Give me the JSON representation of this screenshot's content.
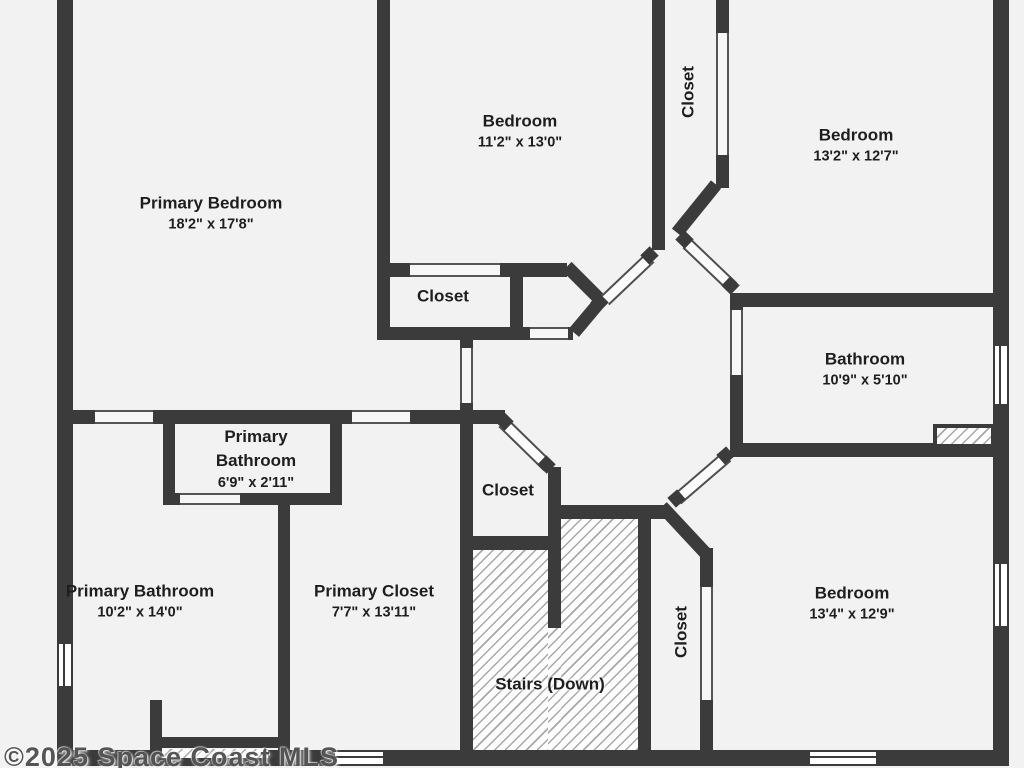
{
  "title": "Second floor plan",
  "watermark": "©2025 Space Coast MLS",
  "rooms": {
    "primary_bedroom": {
      "name": "Primary Bedroom",
      "dims": "18'2\" x 17'8\""
    },
    "bedroom_top": {
      "name": "Bedroom",
      "dims": "11'2\" x 13'0\""
    },
    "closet_top": {
      "name": "Closet"
    },
    "bedroom_right": {
      "name": "Bedroom",
      "dims": "13'2\" x 12'7\""
    },
    "closet_mid": {
      "name": "Closet"
    },
    "bathroom": {
      "name": "Bathroom",
      "dims": "10'9\" x 5'10\""
    },
    "primary_wc": {
      "name": "Primary Bathroom",
      "dims": "6'9\" x 2'11\""
    },
    "closet_hall": {
      "name": "Closet"
    },
    "primary_bathroom": {
      "name": "Primary Bathroom",
      "dims": "10'2\" x 14'0\""
    },
    "primary_closet": {
      "name": "Primary Closet",
      "dims": "7'7\" x 13'11\""
    },
    "stairs": {
      "name": "Stairs (Down)"
    },
    "closet_bottom": {
      "name": "Closet"
    },
    "bedroom_bottom": {
      "name": "Bedroom",
      "dims": "13'4\" x 12'9\""
    }
  },
  "colors": {
    "wall": "#3b3b3b",
    "floor": "#f2f2f2",
    "hatch_line": "#a8a8a8",
    "text": "#1e1e1e"
  }
}
